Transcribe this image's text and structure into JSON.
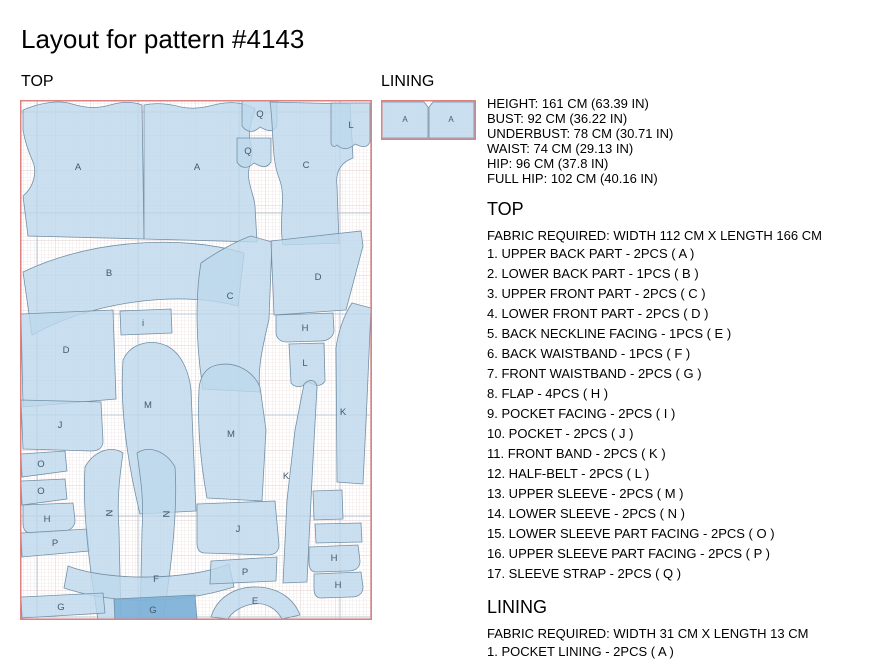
{
  "title": "Layout for pattern #4143",
  "top_section_label": "TOP",
  "lining_section_label": "LINING",
  "measurements": [
    "HEIGHT: 161 CM (63.39 IN)",
    "BUST: 92 CM (36.22 IN)",
    "UNDERBUST: 78 CM (30.71 IN)",
    "WAIST: 74 CM (29.13 IN)",
    "HIP: 96 CM (37.8 IN)",
    "FULL HIP: 102 CM (40.16 IN)"
  ],
  "top_details": {
    "heading": "TOP",
    "fabric": "FABRIC REQUIRED: WIDTH 112 CM X LENGTH 166 CM",
    "items": [
      "1. UPPER BACK PART - 2PCS ( A )",
      "2. LOWER BACK PART - 1PCS ( B )",
      "3. UPPER FRONT PART - 2PCS ( C )",
      "4. LOWER FRONT PART - 2PCS ( D )",
      "5. BACK NECKLINE FACING - 1PCS ( E )",
      "6. BACK WAISTBAND - 1PCS ( F )",
      "7. FRONT WAISTBAND - 2PCS ( G )",
      "8. FLAP - 4PCS ( H )",
      "9. POCKET FACING - 2PCS ( I )",
      "10. POCKET - 2PCS ( J )",
      "11. FRONT BAND - 2PCS ( K )",
      "12. HALF-BELT - 2PCS ( L )",
      "13. UPPER SLEEVE - 2PCS ( M )",
      "14. LOWER SLEEVE - 2PCS ( N )",
      "15. LOWER SLEEVE PART FACING - 2PCS ( O )",
      "16. UPPER SLEEVE PART FACING - 2PCS ( P )",
      "17. SLEEVE STRAP - 2PCS ( Q )"
    ]
  },
  "lining_details": {
    "heading": "LINING",
    "fabric": "FABRIC REQUIRED: WIDTH 31 CM X LENGTH 13 CM",
    "items": [
      "1. POCKET LINING - 2PCS ( A )"
    ]
  },
  "colors": {
    "piece_fill": "#bdd8ec",
    "piece_fill_dark": "#7fb2d8",
    "piece_stroke": "#7490a6",
    "piece_label": "#44596b",
    "grid_minor": "#ead9d9",
    "grid_medium": "#dcc5c5",
    "grid_major_blue": "#b9c7d6",
    "fabric_border": "#dd8181"
  },
  "top_layout": {
    "width": 352,
    "height": 520,
    "major_v": [
      17,
      118,
      219,
      320
    ],
    "major_h": [
      12,
      113,
      214,
      315,
      416,
      517
    ],
    "pieces": [
      {
        "letter": "A",
        "lx": 58,
        "ly": 70,
        "d": "M3,10 C22,2 40,0 52,4 C66,8 76,9 90,5 C104,1 114,2 122,5 L124,139 L8,136 L3,96 C14,87 17,72 13,62 C9,53 5,42 3,30 Z"
      },
      {
        "letter": "A",
        "lx": 177,
        "ly": 70,
        "d": "M124,5 C138,2 150,4 161,7 C174,10 186,7 198,4 C212,1 226,3 235,9 C231,22 227,33 231,45 C235,58 226,68 229,80 C231,92 234,96 235,106 L237,142 L124,139 Z"
      },
      {
        "letter": "Q",
        "lx": 240,
        "ly": 17,
        "d": "M222,1 L257,1 L257,26 C252,34 246,30 240,27 C234,33 227,33 222,26 Z"
      },
      {
        "letter": "Q",
        "lx": 228,
        "ly": 54,
        "d": "M217,38 L251,38 L251,62 C246,70 240,66 234,63 C228,69 221,69 217,62 Z"
      },
      {
        "letter": "C",
        "lx": 286,
        "ly": 68,
        "d": "M250,2 L330,4 L333,58 C322,62 315,70 317,86 L319,143 L263,145 C258,118 267,98 259,78 C251,58 254,28 250,2 Z"
      },
      {
        "letter": "L",
        "lx": 331,
        "ly": 28,
        "d": "M311,3 L350,3 L350,42 C346,50 340,46 335,44 C329,50 322,50 317,45 C314,48 311,46 311,42 Z"
      },
      {
        "letter": "B",
        "lx": 89,
        "ly": 176,
        "d": "M3,172 C70,140 160,134 224,153 L218,206 C155,190 72,202 12,235 Z"
      },
      {
        "letter": "C",
        "lx": 210,
        "ly": 199,
        "d": "M181,163 C198,151 219,140 231,136 L252,142 L249,219 C243,246 237,268 240,292 L183,289 C176,247 175,197 181,163 Z"
      },
      {
        "letter": "D",
        "lx": 298,
        "ly": 180,
        "d": "M251,141 L341,131 L343,146 L326,210 L254,215 Z"
      },
      {
        "letter": "H",
        "lx": 285,
        "ly": 231,
        "d": "M256,215 L313,213 L314,231 C313,238 307,241 300,241 L267,242 C260,242 256,238 256,232 Z"
      },
      {
        "letter": "L",
        "lx": 285,
        "ly": 266,
        "d": "M269,244 L304,243 L305,281 C300,289 293,284 288,282 C282,288 275,288 271,283 Z"
      },
      {
        "letter": "i",
        "lx": 123,
        "ly": 226,
        "d": "M100,211 L151,209 L152,233 L101,235 Z"
      },
      {
        "letter": "D",
        "lx": 46,
        "ly": 253,
        "d": "M1,214 L93,210 L96,299 L3,307 Z"
      },
      {
        "letter": "M",
        "lx": 128,
        "ly": 308,
        "d": "M103,260 C110,244 130,238 147,246 C161,253 169,271 171,290 L176,411 L120,414 C111,377 99,318 103,260 Z"
      },
      {
        "letter": "M",
        "lx": 211,
        "ly": 337,
        "d": "M179,289 C180,275 187,267 197,265 C216,261 233,271 240,287 L246,330 L242,401 L187,398 C181,365 177,329 179,289 Z"
      },
      {
        "letter": "J",
        "lx": 40,
        "ly": 328,
        "d": "M1,300 L81,302 L83,341 C83,348 78,351 71,351 L3,349 Z"
      },
      {
        "letter": "O",
        "lx": 21,
        "ly": 367,
        "d": "M1,354 L45,351 L47,371 L2,377 Z"
      },
      {
        "letter": "O",
        "lx": 21,
        "ly": 394,
        "d": "M1,381 L45,379 L47,399 L2,405 Z"
      },
      {
        "letter": "K",
        "lx": 323,
        "ly": 315,
        "d": "M332,203 L351,208 L347,300 L343,384 L317,382 L316,248 C318,232 324,215 332,203 Z"
      },
      {
        "letter": "K",
        "lx": 266,
        "ly": 379,
        "d": "M284,284 C290,278 296,280 297,287 L293,360 L289,440 L287,482 L263,483 L267,400 L275,330 Z"
      },
      {
        "letter": "H",
        "lx": 27,
        "ly": 422,
        "d": "M3,405 L53,403 L55,420 C55,427 50,431 43,431 L11,433 C5,433 3,429 3,423 Z"
      },
      {
        "letter": "P",
        "lx": 35,
        "ly": 446,
        "d": "M1,433 L67,429 L69,451 L2,457 Z"
      },
      {
        "letter": "N",
        "lx": 86,
        "ly": 413,
        "rot": 90,
        "d": "M65,367 C74,351 91,345 103,353 C99,380 97,402 99,430 L101,524 L79,526 C70,471 62,412 65,367 Z"
      },
      {
        "letter": "N",
        "lx": 143,
        "ly": 414,
        "rot": 90,
        "d": "M117,353 C129,345 146,351 155,367 C158,412 151,471 142,526 L120,524 L122,430 C124,402 121,380 117,353 Z"
      },
      {
        "letter": "F",
        "lx": 136,
        "ly": 482,
        "d": "M48,466 C90,482 170,480 209,464 L214,487 C160,504 95,505 44,488 Z"
      },
      {
        "letter": "G",
        "lx": 41,
        "ly": 510,
        "d": "M1,497 L83,493 L85,513 L2,518 Z"
      },
      {
        "letter": "G",
        "lx": 133,
        "ly": 513,
        "dark": true,
        "d": "M94,499 L175,495 L177,519 L95,523 Z"
      },
      {
        "letter": "J",
        "lx": 218,
        "ly": 432,
        "d": "M177,404 L255,401 L259,445 C259,452 254,455 247,455 L185,453 C179,453 177,449 177,443 Z"
      },
      {
        "letter": "P",
        "lx": 225,
        "ly": 475,
        "d": "M191,461 L257,457 L256,481 L190,484 Z"
      },
      {
        "letter": "E",
        "lx": 235,
        "ly": 504,
        "d": "M191,517 C197,497 216,486 238,487 C259,488 274,499 280,515 L262,519 C256,508 245,502 233,504 C221,506 212,512 208,519 Z"
      },
      {
        "letter": "H",
        "lx": 314,
        "ly": 461,
        "d": "M289,447 L338,445 L340,461 C340,468 335,471 328,471 L296,472 C291,472 289,468 289,462 Z"
      },
      {
        "letter": "H",
        "lx": 318,
        "ly": 488,
        "d": "M294,474 L341,472 L343,487 C343,494 338,497 331,497 L301,498 C296,498 294,494 294,488 Z"
      },
      {
        "letter": "",
        "lx": 0,
        "ly": 0,
        "d": "M293,391 L322,390 L323,419 L294,420 Z"
      },
      {
        "letter": "",
        "lx": 0,
        "ly": 0,
        "d": "M295,424 L341,423 L342,442 L296,443 Z"
      }
    ]
  },
  "lining_layout": {
    "width": 95,
    "height": 40,
    "pieces": [
      {
        "letter": "A",
        "lx": 24,
        "ly": 22,
        "d": "M1,2 L43,2 L47,7 L47,38 L1,38 Z"
      },
      {
        "letter": "A",
        "lx": 70,
        "ly": 22,
        "d": "M48,7 L52,2 L93,2 L93,38 L48,38 Z"
      }
    ]
  }
}
